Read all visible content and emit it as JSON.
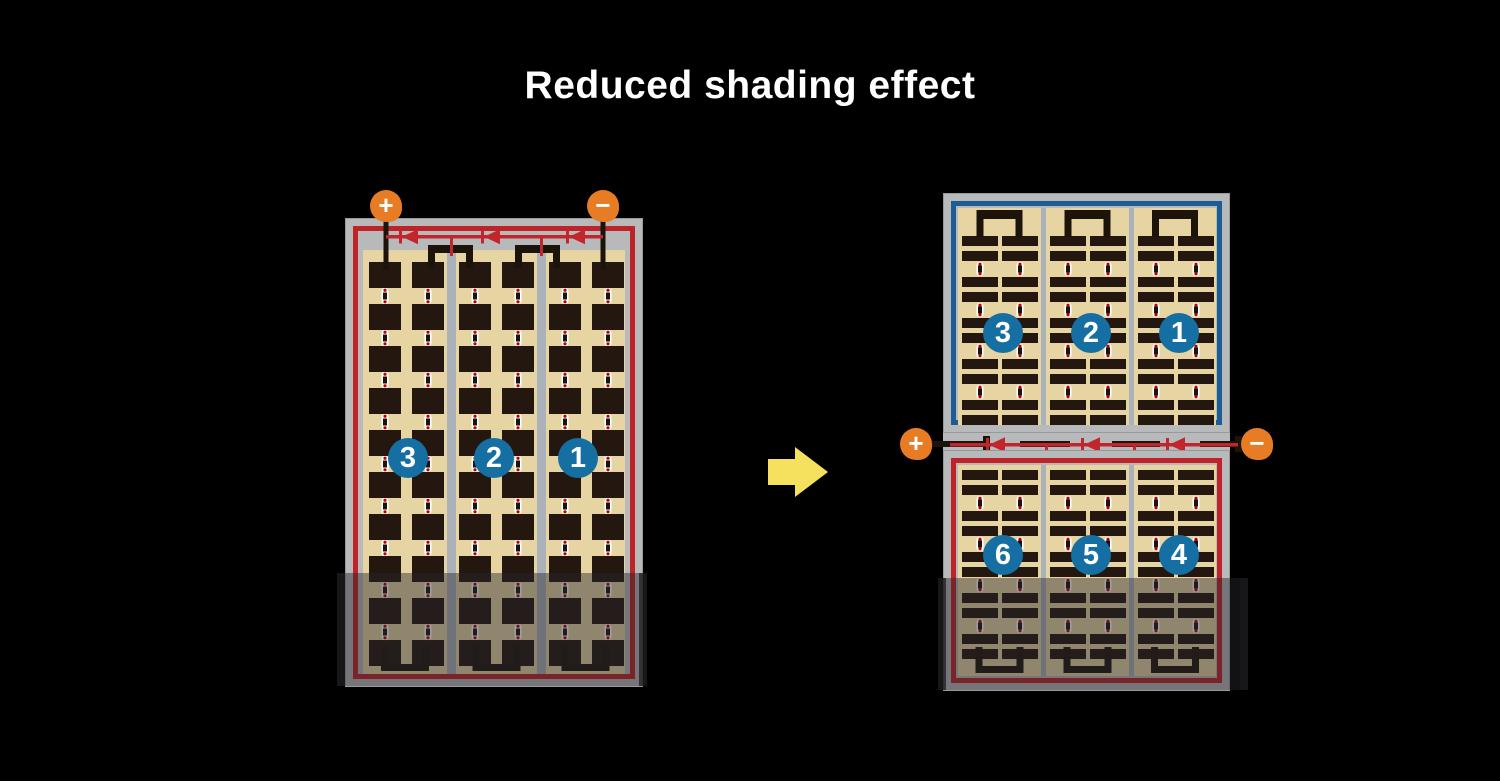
{
  "title": {
    "text": "Reduced shading effect"
  },
  "colors": {
    "background": "#000000",
    "title_white": "#ffffff",
    "orange": "#e87c24",
    "badge_blue": "#166fa3",
    "red_border": "#be2328",
    "blue_border": "#1d5c94",
    "diode_red": "#c0262b",
    "tan": "#e6d5a3",
    "cell_dark": "#241710",
    "frame_gray": "#b7b9bb",
    "frame_edge": "#97999b",
    "divider_gray": "#abb1b8",
    "bus_black": "#1c130b",
    "connector_white": "#ffffff",
    "connector_dot_red": "#c00000",
    "arrow_yellow": "#f6e15e",
    "shade": "rgba(40,38,44,0.45)",
    "shade_edge": "rgba(25,25,28,0.72)"
  },
  "left_panel": {
    "terminal_plus": "+",
    "terminal_minus": "−",
    "string_labels": [
      "3",
      "2",
      "1"
    ]
  },
  "right_assembly": {
    "terminal_plus": "+",
    "terminal_minus": "−",
    "top_panel": {
      "string_labels": [
        "3",
        "2",
        "1"
      ]
    },
    "bottom_panel": {
      "string_labels": [
        "6",
        "5",
        "4"
      ]
    }
  }
}
